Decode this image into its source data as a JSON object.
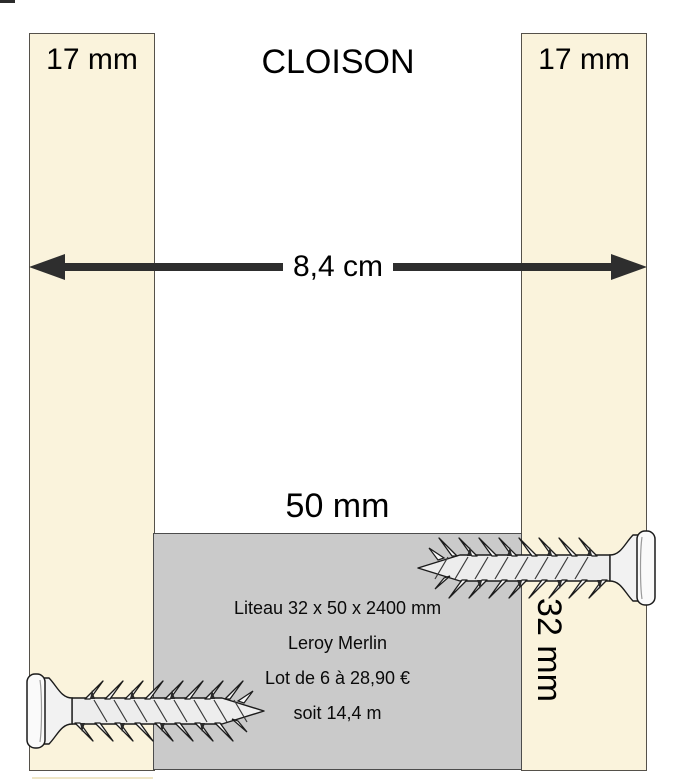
{
  "title": "CLOISON",
  "colors": {
    "panel_fill": "#FAF3DC",
    "panel_border": "#55514A",
    "block_fill": "#CACACA",
    "block_border": "#4C4C4C",
    "arrow": "#2E2E2E",
    "text": "#111111",
    "canvas_bg": "#FFFFFF"
  },
  "panels": {
    "left_label": "17 mm",
    "right_label": "17 mm",
    "right_side_label": "32 mm"
  },
  "width_arrow": {
    "label": "8,4 cm"
  },
  "liteau_block": {
    "width_label": "50 mm",
    "lines": [
      "Liteau 32 x 50 x 2400 mm",
      "Leroy Merlin",
      "Lot de 6 à 28,90 €",
      "soit 14,4 m"
    ]
  },
  "icons": {
    "top_screw": "screw-icon",
    "bottom_screw": "screw-icon"
  }
}
